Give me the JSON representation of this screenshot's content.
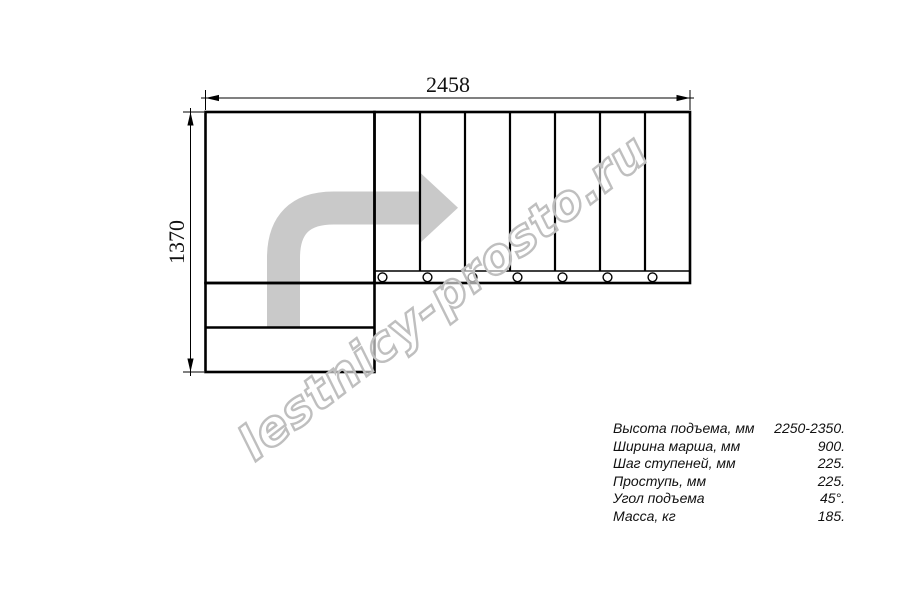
{
  "dimensions": {
    "width_mm": "2458",
    "height_mm": "1370"
  },
  "watermark": {
    "text": "lestnicy-prosto.ru"
  },
  "specs": {
    "rows": [
      {
        "label": "Высота подъема, мм",
        "value": "2250-2350."
      },
      {
        "label": "Ширина марша, мм",
        "value": "900."
      },
      {
        "label": "Шаг ступеней, мм",
        "value": "225."
      },
      {
        "label": "Проступь, мм",
        "value": "225."
      },
      {
        "label": "Угол подъема",
        "value": "45°."
      },
      {
        "label": "Масса, кг",
        "value": "185."
      }
    ]
  },
  "colors": {
    "line": "#000000",
    "arrow": "#c9c9c9",
    "watermark": "#bfbfbf"
  }
}
